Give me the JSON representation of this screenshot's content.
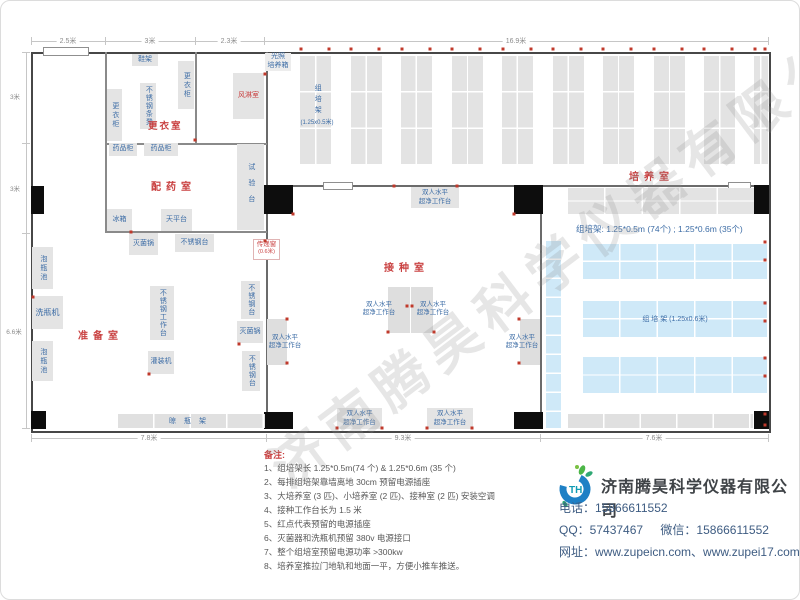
{
  "watermark": "济南腾昊科学仪器有限公司",
  "dims": {
    "top": [
      "2.5米",
      "3米",
      "2.3米",
      "16.9米"
    ],
    "left": [
      "3米",
      "3米",
      "6.6米"
    ],
    "bottom": [
      "7.8米",
      "9.3米",
      "7.6米"
    ]
  },
  "rooms": {
    "changing": "更衣室",
    "air_shower": "风淋室",
    "dispensing": "配药室",
    "prep": "准备室",
    "inoculation": "接种室",
    "culture": "培养室"
  },
  "equipment": {
    "shoe_rack": "鞋架",
    "locker": "更衣柜",
    "steel_bench": "不锈钢条凳",
    "medicine_cabinet": "药品柜",
    "test_bench": "试验台",
    "fridge": "冰箱",
    "balance_table": "天平台",
    "sterilizer": "灭菌锅",
    "steel_table": "不锈钢台",
    "steel_worktable": "不锈钢工作台",
    "soak_pool": "泡瓶池",
    "bottle_washer": "洗瓶机",
    "filling_machine": "灌装机",
    "drying_rack": "晾瓶架",
    "laminar_flow": "双人水平\n超净工作台",
    "light_incubator": "光照\n培养箱",
    "pass_window": "传递窗",
    "pass_window_size": "(0.6米)",
    "rack_col_label": "组培架",
    "rack_col_size": "(1.25x0.5米)",
    "rack_row_label": "组  培  架 (1.25x0.6米)",
    "culture_note": "组培架: 1.25*0.5m (74个) ; 1.25*0.6m (35个)"
  },
  "notes": {
    "title": "备注:",
    "items": [
      "1、组培架长 1.25*0.5m(74 个) & 1.25*0.6m (35 个)",
      "2、每排组培架靠墙离地 30cm 预留电源插座",
      "3、大培养室 (3 匹)、小培养室 (2 匹)、接种室 (2 匹) 安装空调",
      "4、接种工作台长为 1.5 米",
      "5、红点代表预留的电源插座",
      "6、灭菌器和洗瓶机预留 380v 电源接口",
      "7、整个组培室预留电源功率 >300kw",
      "8、培养室推拉门地轨和地面一平，方便小推车推送。"
    ]
  },
  "company": {
    "name": "济南腾昊科学仪器有限公司",
    "logo_text": "TH",
    "phone_label": "电话：",
    "phone": "15866611552",
    "qq_label": "QQ：",
    "qq": "57437467",
    "wechat_label": "微信：",
    "wechat": "15866611552",
    "web_label": "网址：",
    "web": "www.zupeicn.com、www.zupei17.com"
  },
  "colors": {
    "room_label": "#c94141",
    "equipment_text": "#3d6da6",
    "rack_gray": "#e3e3e3",
    "rack_blue": "#cfe9f8",
    "outlet_red": "#c0392b",
    "wall": "#474747"
  },
  "outlets": [
    [
      300,
      48
    ],
    [
      328,
      48
    ],
    [
      350,
      48
    ],
    [
      378,
      48
    ],
    [
      401,
      48
    ],
    [
      429,
      48
    ],
    [
      451,
      48
    ],
    [
      479,
      48
    ],
    [
      502,
      48
    ],
    [
      530,
      48
    ],
    [
      552,
      48
    ],
    [
      580,
      48
    ],
    [
      602,
      48
    ],
    [
      630,
      48
    ],
    [
      653,
      48
    ],
    [
      681,
      48
    ],
    [
      703,
      48
    ],
    [
      731,
      48
    ],
    [
      754,
      48
    ],
    [
      764,
      48
    ],
    [
      764,
      241
    ],
    [
      764,
      259
    ],
    [
      764,
      302
    ],
    [
      764,
      320
    ],
    [
      764,
      357
    ],
    [
      764,
      375
    ],
    [
      764,
      413
    ],
    [
      764,
      424
    ],
    [
      32,
      296
    ],
    [
      130,
      231
    ],
    [
      194,
      139
    ],
    [
      264,
      73
    ],
    [
      148,
      373
    ],
    [
      238,
      343
    ],
    [
      264,
      240
    ],
    [
      393,
      185
    ],
    [
      456,
      185
    ],
    [
      406,
      305
    ],
    [
      411,
      305
    ],
    [
      387,
      331
    ],
    [
      433,
      331
    ],
    [
      286,
      318
    ],
    [
      286,
      362
    ],
    [
      518,
      318
    ],
    [
      518,
      362
    ],
    [
      336,
      427
    ],
    [
      381,
      427
    ],
    [
      426,
      427
    ],
    [
      471,
      427
    ],
    [
      292,
      213
    ],
    [
      513,
      213
    ]
  ]
}
